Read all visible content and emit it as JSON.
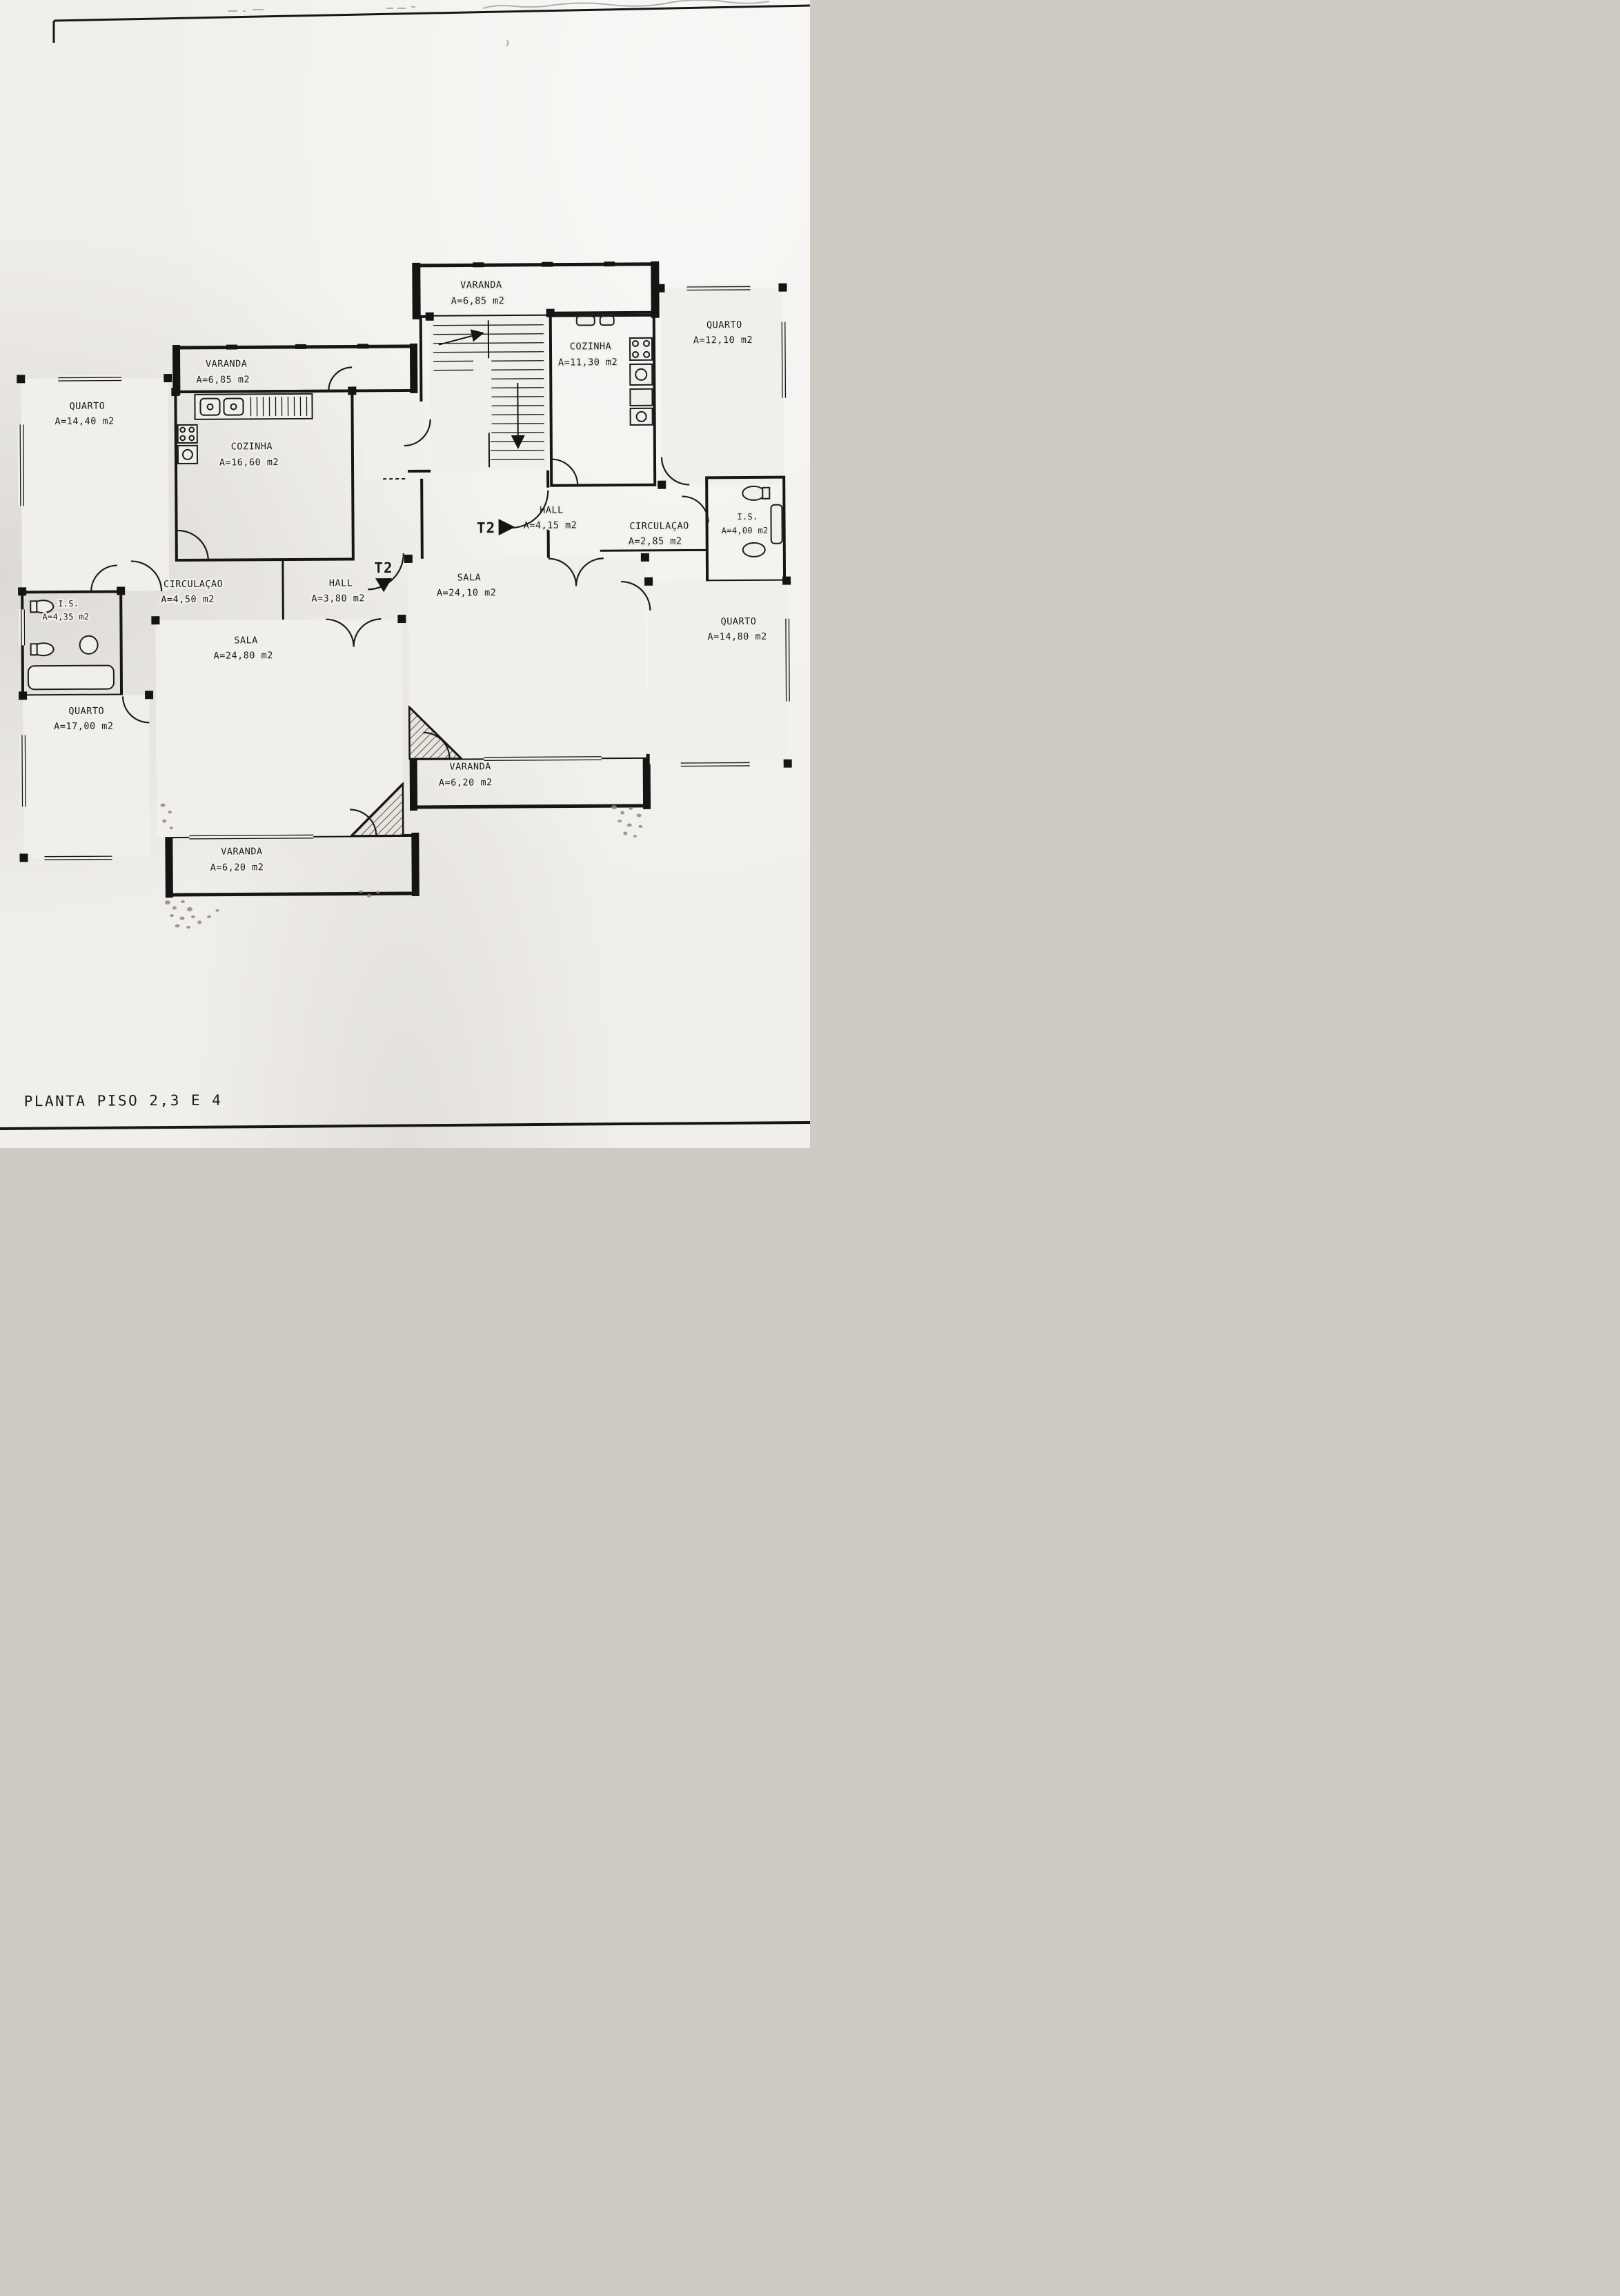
{
  "page": {
    "title": "PLANTA PISO 2,3 E 4",
    "paper_color": "#f1efeb",
    "ink_color": "#1a1a1a"
  },
  "unit_markers": {
    "right_entry": "T2",
    "left_entry": "T2"
  },
  "rooms": [
    {
      "name": "VARANDA",
      "area": "A=6,85 m2"
    },
    {
      "name": "QUARTO",
      "area": "A=12,10 m2"
    },
    {
      "name": "COZINHA",
      "area": "A=11,30 m2"
    },
    {
      "name": "VARANDA",
      "area": "A=6,85 m2"
    },
    {
      "name": "QUARTO",
      "area": "A=14,40 m2"
    },
    {
      "name": "COZINHA",
      "area": "A=16,60 m2"
    },
    {
      "name": "HALL",
      "area": "A=4,15 m2"
    },
    {
      "name": "CIRCULAÇAO",
      "area": "A=2,85 m2"
    },
    {
      "name": "I.S.",
      "area": "A=4,00 m2"
    },
    {
      "name": "CIRCULAÇAO",
      "area": "A=4,50 m2"
    },
    {
      "name": "HALL",
      "area": "A=3,80 m2"
    },
    {
      "name": "SALA",
      "area": "A=24,10 m2"
    },
    {
      "name": "I.S.",
      "area": "A=4,35 m2"
    },
    {
      "name": "SALA",
      "area": "A=24,80 m2"
    },
    {
      "name": "QUARTO",
      "area": "A=14,80 m2"
    },
    {
      "name": "QUARTO",
      "area": "A=17,00 m2"
    },
    {
      "name": "VARANDA",
      "area": "A=6,20 m2"
    },
    {
      "name": "VARANDA",
      "area": "A=6,20 m2"
    }
  ]
}
